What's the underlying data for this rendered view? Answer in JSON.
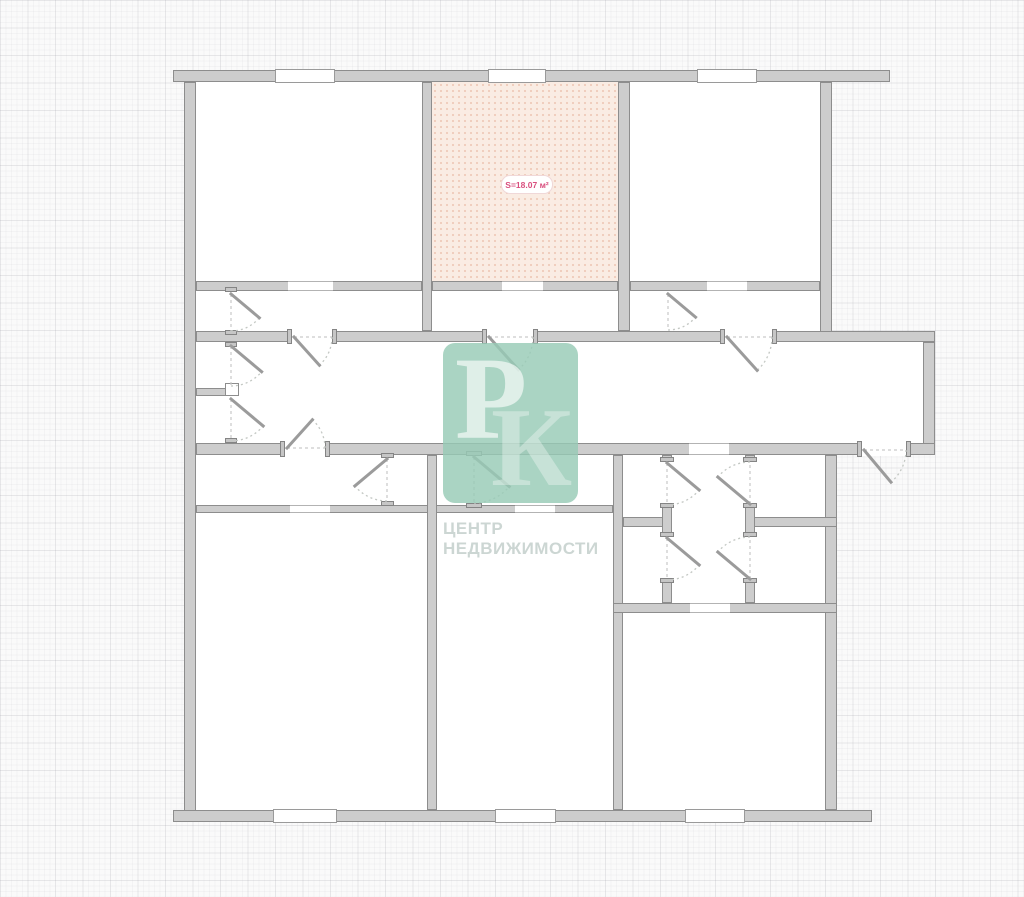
{
  "watermark": {
    "letter_p": "Р",
    "letter_k": "К",
    "line1": "ЦЕНТР",
    "line2": "НЕДВИЖИМОСТИ"
  },
  "label": {
    "text": "S=18.07 м²"
  },
  "colors": {
    "wall_fill": "#cdcdcd",
    "wall_stroke": "#8d8d8d",
    "highlight_room_fill": "#faece3",
    "watermark_teal": "#97cbb6",
    "label_text": "#d94f7e",
    "background": "#fafafa"
  },
  "plan": {
    "width": 1024,
    "height": 897,
    "rooms": [
      {
        "x": 184,
        "y": 70,
        "w": 648,
        "h": 385,
        "f": "white"
      },
      {
        "x": 832,
        "y": 331,
        "w": 103,
        "h": 124,
        "f": "white"
      },
      {
        "x": 184,
        "y": 455,
        "w": 653,
        "h": 367,
        "f": "white"
      },
      {
        "x": 432,
        "y": 82,
        "w": 186,
        "h": 199,
        "f": "pink"
      }
    ],
    "walls": [
      [
        173,
        70,
        717,
        12
      ],
      [
        184,
        82,
        12,
        740
      ],
      [
        173,
        810,
        699,
        12
      ],
      [
        820,
        82,
        12,
        259
      ],
      [
        196,
        331,
        739,
        11
      ],
      [
        923,
        342,
        12,
        113
      ],
      [
        196,
        443,
        739,
        12
      ],
      [
        422,
        82,
        10,
        249
      ],
      [
        618,
        82,
        12,
        249
      ],
      [
        196,
        281,
        226,
        10
      ],
      [
        432,
        281,
        186,
        10
      ],
      [
        630,
        281,
        190,
        10
      ],
      [
        196,
        388,
        39,
        8
      ],
      [
        196,
        505,
        417,
        8
      ],
      [
        427,
        455,
        10,
        355
      ],
      [
        613,
        455,
        10,
        355
      ],
      [
        825,
        455,
        12,
        355
      ],
      [
        623,
        517,
        49,
        10
      ],
      [
        745,
        517,
        92,
        10
      ],
      [
        613,
        603,
        224,
        10
      ],
      [
        662,
        455,
        10,
        7
      ],
      [
        662,
        505,
        10,
        32
      ],
      [
        662,
        580,
        10,
        23
      ],
      [
        745,
        455,
        10,
        7
      ],
      [
        745,
        505,
        10,
        32
      ],
      [
        745,
        580,
        10,
        23
      ]
    ],
    "gaps": [
      [
        292,
        330,
        40,
        13
      ],
      [
        487,
        330,
        46,
        13
      ],
      [
        725,
        330,
        47,
        13
      ],
      [
        285,
        442,
        40,
        14
      ],
      [
        862,
        442,
        44,
        14
      ]
    ],
    "jambs": [
      [
        287,
        329,
        5,
        15
      ],
      [
        332,
        329,
        5,
        15
      ],
      [
        482,
        329,
        5,
        15
      ],
      [
        533,
        329,
        5,
        15
      ],
      [
        720,
        329,
        5,
        15
      ],
      [
        772,
        329,
        5,
        15
      ],
      [
        280,
        441,
        5,
        16
      ],
      [
        325,
        441,
        5,
        16
      ],
      [
        857,
        441,
        5,
        16
      ],
      [
        906,
        441,
        5,
        16
      ],
      [
        225,
        287,
        12,
        5
      ],
      [
        225,
        330,
        12,
        5
      ],
      [
        225,
        342,
        12,
        5
      ],
      [
        225,
        384,
        12,
        5
      ],
      [
        225,
        391,
        12,
        5
      ],
      [
        225,
        438,
        12,
        5
      ],
      [
        381,
        453,
        13,
        5
      ],
      [
        381,
        501,
        13,
        5
      ],
      [
        466,
        451,
        16,
        5
      ],
      [
        466,
        503,
        16,
        5
      ],
      [
        660,
        457,
        14,
        5
      ],
      [
        660,
        503,
        14,
        5
      ],
      [
        660,
        532,
        14,
        5
      ],
      [
        660,
        578,
        14,
        5
      ],
      [
        743,
        457,
        14,
        5
      ],
      [
        743,
        503,
        14,
        5
      ],
      [
        743,
        532,
        14,
        5
      ],
      [
        743,
        578,
        14,
        5
      ]
    ],
    "windows": [
      [
        275,
        69,
        60,
        14
      ],
      [
        488,
        69,
        58,
        14
      ],
      [
        697,
        69,
        60,
        14
      ],
      [
        273,
        809,
        64,
        14
      ],
      [
        495,
        809,
        61,
        14
      ],
      [
        685,
        809,
        60,
        14
      ]
    ],
    "openings": [
      [
        288,
        281,
        45,
        10
      ],
      [
        502,
        281,
        41,
        10
      ],
      [
        707,
        281,
        40,
        10
      ],
      [
        290,
        505,
        40,
        8
      ],
      [
        515,
        505,
        40,
        8
      ],
      [
        690,
        603,
        40,
        10
      ],
      [
        689,
        443,
        40,
        12
      ]
    ],
    "caps": [
      [
        225,
        383,
        14,
        13
      ]
    ],
    "doors": [
      [
        294,
        337,
        38,
        0,
        48
      ],
      [
        489,
        337,
        44,
        0,
        48
      ],
      [
        727,
        337,
        45,
        0,
        48
      ],
      [
        287,
        448,
        38,
        0,
        -48
      ],
      [
        864,
        450,
        42,
        0,
        50
      ],
      [
        231,
        294,
        37,
        90,
        40
      ],
      [
        231,
        346,
        40,
        90,
        40
      ],
      [
        231,
        399,
        42,
        90,
        40
      ],
      [
        387,
        459,
        42,
        90,
        140
      ],
      [
        474,
        457,
        46,
        90,
        40
      ],
      [
        668,
        294,
        36,
        90,
        40
      ],
      [
        667,
        463,
        42,
        90,
        40
      ],
      [
        667,
        538,
        42,
        90,
        40
      ],
      [
        750,
        504,
        42,
        270,
        220
      ],
      [
        750,
        579,
        42,
        270,
        220
      ]
    ]
  }
}
